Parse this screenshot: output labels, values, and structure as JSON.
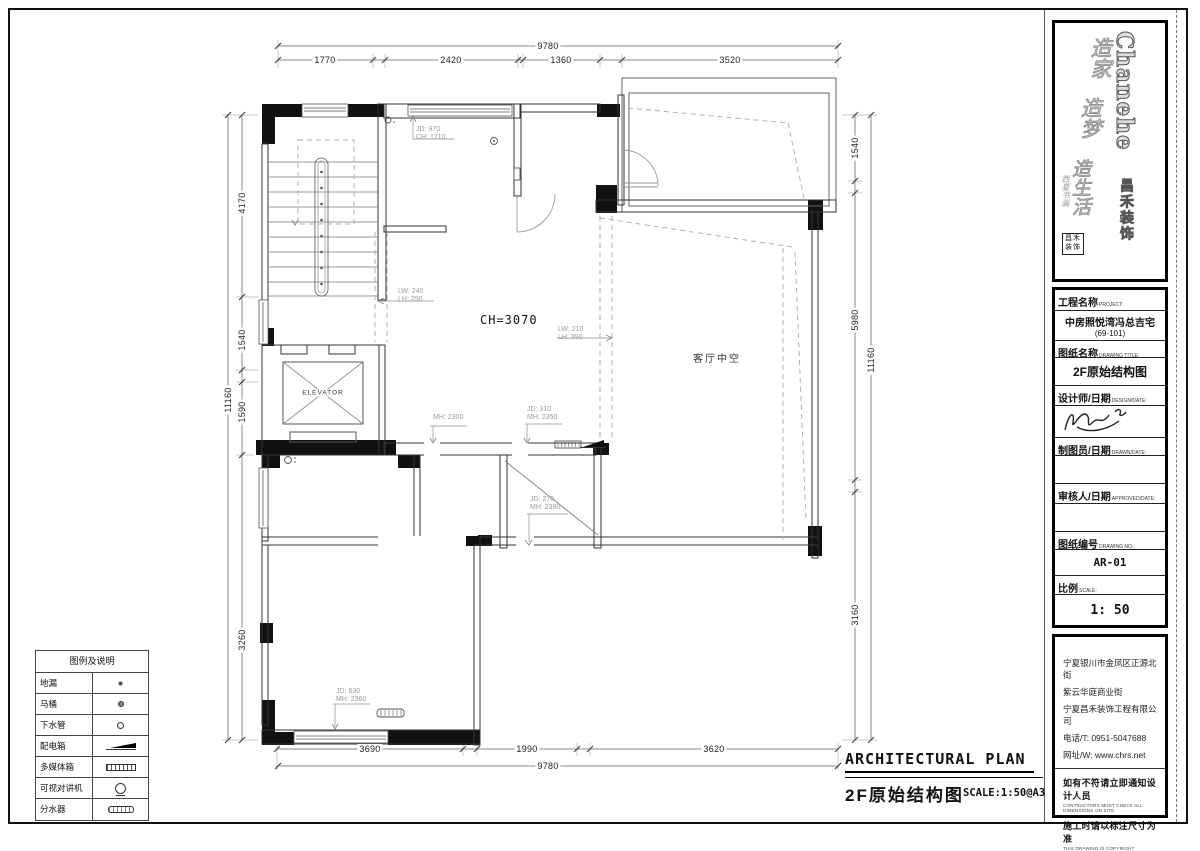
{
  "dims": {
    "top": {
      "overall": "9780",
      "segments": [
        "1770",
        "2420",
        "1360",
        "3520"
      ]
    },
    "bottom": {
      "overall": "9780",
      "segments": [
        "3690",
        "1990",
        "3620"
      ]
    },
    "left": {
      "overall": "11160",
      "segments": [
        "4170",
        "1540",
        "1590",
        "3260"
      ]
    },
    "right": {
      "overall": "11160",
      "segments": [
        "1540",
        "5980",
        "3160"
      ]
    }
  },
  "plan": {
    "ceiling_height": "CH=3070",
    "void_label": "客厅中空",
    "elevator_label": "ELEVATOR",
    "notes": [
      {
        "l1": "JD: 970",
        "l2": "CH: 1710"
      },
      {
        "l1": "LW: 240",
        "l2": "LH: 290"
      },
      {
        "l1": "LW: 210",
        "l2": "LH: 390"
      },
      {
        "l1": "MH: 2300",
        "l2": ""
      },
      {
        "l1": "JD: 310",
        "l2": "MH: 2350"
      },
      {
        "l1": "JD: 270",
        "l2": "MH: 2380"
      },
      {
        "l1": "JD: 630",
        "l2": "MH: 2360"
      }
    ]
  },
  "legend": {
    "title": "图例及说明",
    "rows": [
      {
        "label": "地漏"
      },
      {
        "label": "马桶"
      },
      {
        "label": "下水管"
      },
      {
        "label": "配电箱"
      },
      {
        "label": "多媒体箱"
      },
      {
        "label": "可视对讲机"
      },
      {
        "label": "分水器"
      }
    ]
  },
  "footer": {
    "title_en": "ARCHITECTURAL PLAN",
    "title_cn": "2F原始结构图",
    "scale": "SCALE:1:50@A3"
  },
  "logo": {
    "brand_en": "Chanehe",
    "brand_cn": "昌禾装饰",
    "slogan1": "造家",
    "slogan2": "造梦",
    "slogan3": "造生活",
    "side_text": "西夏书画",
    "seal_text": "昌禾装饰"
  },
  "titleblock": {
    "project_label": "工程名称",
    "project_label_en": "PROJECT:",
    "project_name": "中房照悦湾冯总吉宅",
    "project_unit": "(69-101)",
    "drawing_label": "图纸名称",
    "drawing_label_en": "DRAWING TITLE:",
    "drawing_title": "2F原始结构图",
    "designer_label": "设计师/日期",
    "designer_label_en": "DESIGN/DATE:",
    "drafter_label": "制图员/日期",
    "drafter_label_en": "DRAWN/DATE:",
    "checker_label": "审核人/日期",
    "checker_label_en": "APPROVED/DATE:",
    "number_label": "图纸编号",
    "number_label_en": "DRAWING NO.:",
    "drawing_no": "AR-01",
    "scale_label": "比例",
    "scale_label_en": "SCALE:",
    "scale_value": "1: 50"
  },
  "company": {
    "address1": "宁夏银川市金凤区正源北街",
    "address2": "紫云华庭商业街",
    "name": "宁夏昌禾装饰工程有限公司",
    "phone": "电话/T: 0951-5047688",
    "web": "网址/W: www.chrs.net",
    "note1_cn": "如有不符请立即通知设计人员",
    "note1_en": "CONTRACTORS MUST CHECK ALL DIMENSIONS ON SITE",
    "note2_cn": "施工时请以标注尺寸为准",
    "note2_en": "THIS DRAWING IS COPYRIGHT"
  }
}
